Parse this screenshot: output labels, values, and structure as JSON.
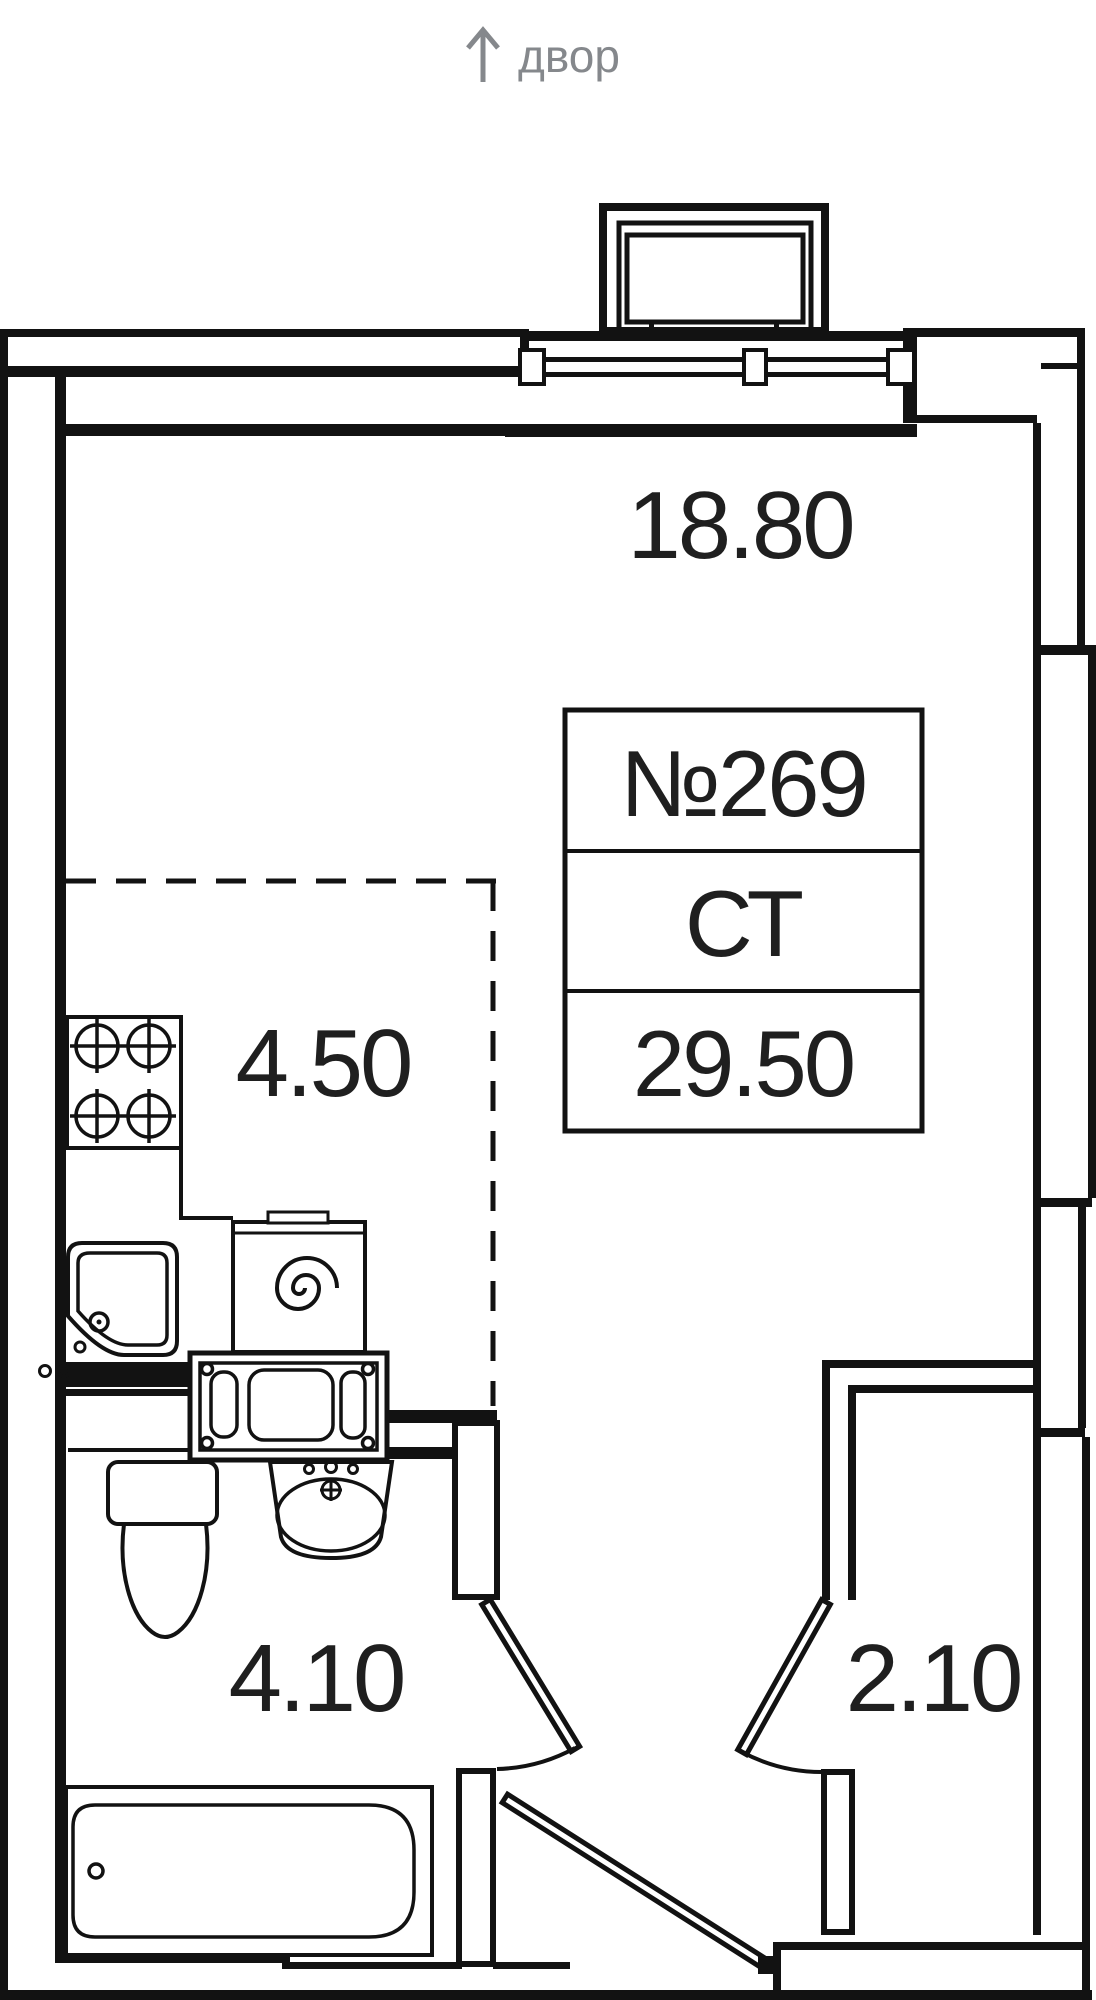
{
  "page": {
    "background": "#ffffff",
    "ink": "#121212",
    "muted": "#85888c"
  },
  "compass": {
    "arrow_icon": "up-arrow",
    "label": "двор"
  },
  "unit_card": {
    "number": "№269",
    "type": "СТ",
    "area_total": "29.50"
  },
  "rooms": {
    "living": {
      "area": "18.80"
    },
    "kitchen": {
      "area": "4.50"
    },
    "bathroom": {
      "area": "4.10"
    },
    "hallway": {
      "area": "2.10"
    }
  },
  "fixtures": [
    "balcony",
    "window",
    "stove",
    "kitchen-sink",
    "washing-machine",
    "cistern-unit",
    "toilet",
    "wash-basin",
    "bathtub",
    "bathroom-door",
    "closet-door",
    "entry-door"
  ]
}
